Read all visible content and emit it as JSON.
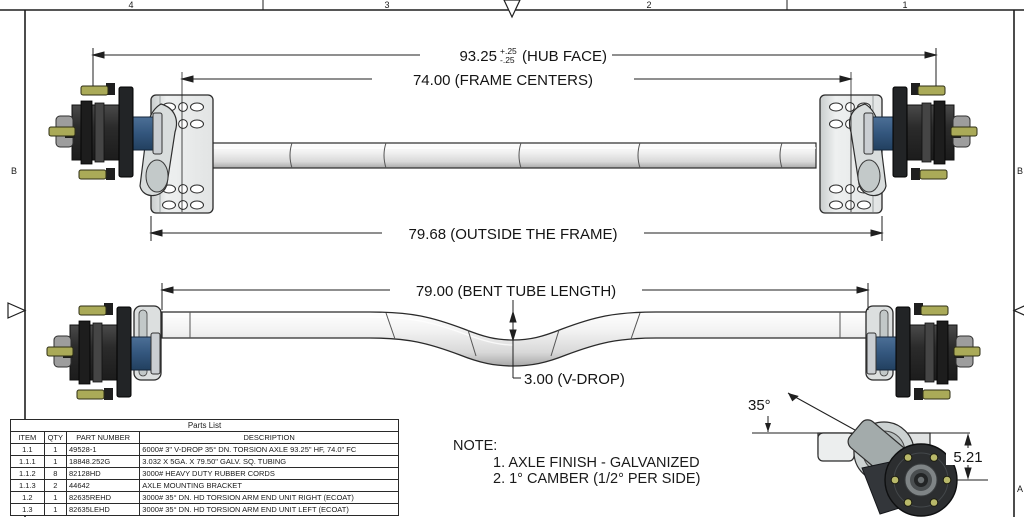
{
  "border": {
    "zones_top": [
      "4",
      "3",
      "2",
      "1"
    ],
    "zone_left_b": "B",
    "zone_left_a": "A",
    "zone_right_b": "B",
    "zone_right_a": "A"
  },
  "dimensions": {
    "hub_face_value": "93.25",
    "hub_face_tol_plus": "+.25",
    "hub_face_tol_minus": "-.25",
    "hub_face_label": "(HUB FACE)",
    "frame_centers": "74.00 (FRAME CENTERS)",
    "outside_frame": "79.68 (OUTSIDE THE FRAME)",
    "bent_tube_length": "79.00 (BENT TUBE LENGTH)",
    "v_drop": "3.00 (V-DROP)",
    "arm_angle": "35°",
    "drop_height": "5.21"
  },
  "notes": {
    "heading": "NOTE:",
    "items": [
      "1. AXLE FINISH - GALVANIZED",
      "2. 1° CAMBER (1/2° PER SIDE)"
    ]
  },
  "parts_table": {
    "title": "Parts List",
    "columns": [
      "ITEM",
      "QTY",
      "PART NUMBER",
      "DESCRIPTION"
    ],
    "rows": [
      {
        "item": "1.1",
        "qty": "1",
        "part_number": "49528-1",
        "description": "6000# 3\" V-DROP 35° DN. TORSION AXLE 93.25\" HF, 74.0\" FC"
      },
      {
        "item": "1.1.1",
        "qty": "1",
        "part_number": "18848.252G",
        "description": "3.032 X 5GA. X 79.50\" GALV. SQ. TUBING"
      },
      {
        "item": "1.1.2",
        "qty": "8",
        "part_number": "82128HD",
        "description": "3000# HEAVY DUTY RUBBER CORDS"
      },
      {
        "item": "1.1.3",
        "qty": "2",
        "part_number": "44642",
        "description": "AXLE MOUNTING BRACKET"
      },
      {
        "item": "1.2",
        "qty": "1",
        "part_number": "82635REHD",
        "description": "3000# 35° DN. HD TORSION ARM END UNIT RIGHT (ECOAT)"
      },
      {
        "item": "1.3",
        "qty": "1",
        "part_number": "82635LEHD",
        "description": "3000# 35° DN. HD TORSION ARM END UNIT LEFT (ECOAT)"
      }
    ]
  },
  "colors": {
    "line": "#1f1f1f",
    "hub_dark": "#2c2e30",
    "stud_olive": "#aaaa58",
    "bearing_blue": "#33567d",
    "steel_light": "#e6e8e8",
    "background": "#ffffff"
  }
}
